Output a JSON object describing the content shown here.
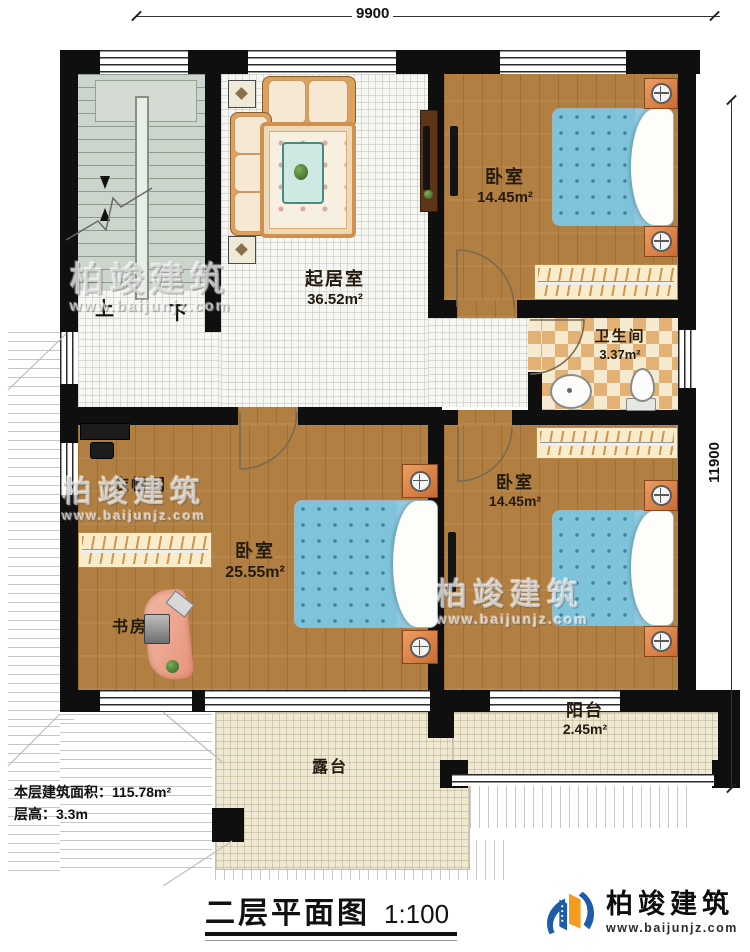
{
  "plan": {
    "title": "二层平面图",
    "scale": "1:100",
    "floor_area_label": "本层建筑面积：115.78m²",
    "floor_height_label": "层高：3.3m",
    "dim_top": "9900",
    "dim_right": "11900"
  },
  "stairs": {
    "up_label": "上",
    "down_label": "下"
  },
  "rooms": {
    "living": {
      "name": "起居室",
      "area": "36.52m²"
    },
    "bedroom_top": {
      "name": "卧室",
      "area": "14.45m²"
    },
    "bathroom": {
      "name": "卫生间",
      "area": "3.37m²"
    },
    "cloakroom": {
      "name": "衣帽间"
    },
    "master_bedroom": {
      "name": "卧室",
      "area": "25.55m²"
    },
    "study": {
      "name": "书房"
    },
    "bedroom_bottom": {
      "name": "卧室",
      "area": "14.45m²"
    },
    "balcony": {
      "name": "阳台",
      "area": "2.45m²"
    },
    "terrace": {
      "name": "露台"
    }
  },
  "branding": {
    "company": "柏竣建筑",
    "website": "www.baijunjz.com"
  },
  "colors": {
    "wall": "#0f0f0f",
    "wood_floor": "#b17f42",
    "mattress_blue": "#7fc3da",
    "checker_tan": "#e3b173",
    "cream_tile": "#efe8d2",
    "stair_grey": "#ccd5cc",
    "logo_blue": "#1d5ca6",
    "logo_orange": "#f59b1e"
  }
}
